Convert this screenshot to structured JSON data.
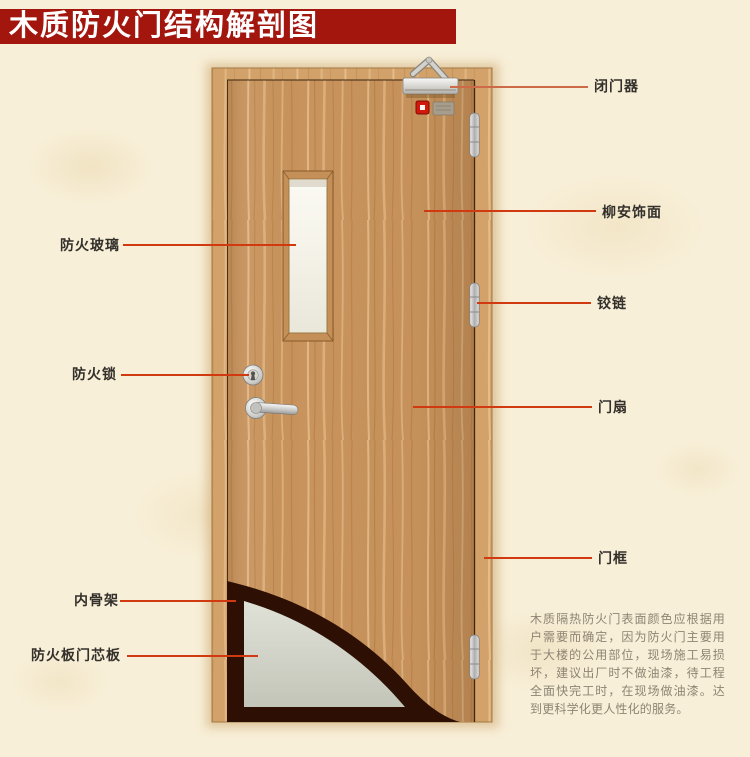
{
  "title": "木质防火门结构解剖图",
  "labels": {
    "fire_glass": "防火玻璃",
    "fire_lock": "防火锁",
    "inner_skeleton": "内骨架",
    "core_panel": "防火板门芯板",
    "door_closer": "闭门器",
    "veneer": "柳安饰面",
    "hinge": "铰链",
    "door_leaf": "门扇",
    "door_frame": "门框"
  },
  "note": "木质隔热防火门表面颜色应根据用户需要而确定，因为防火门主要用于大楼的公用部位，现场施工易损坏，建议出厂时不做油漆，待工程全面快完工时，在现场做油漆。达到更科学化更人性化的服务。",
  "colors": {
    "title_bar": "#a2160e",
    "background": "#f8efd8",
    "leader_line": "#d13a10",
    "door_wood": "#c8935c",
    "frame_wood": "#d2a26a",
    "core_panel": "#d4d6cc",
    "inner_skeleton": "#2d1003",
    "label_text": "#33302b",
    "note_text": "#8d8473"
  }
}
